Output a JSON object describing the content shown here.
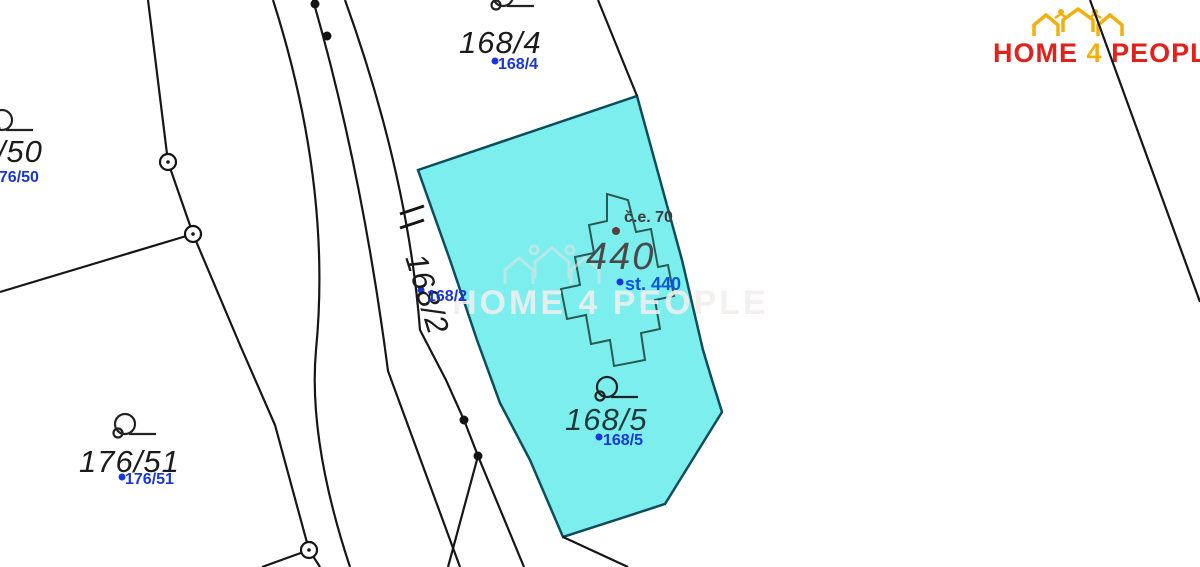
{
  "logo": {
    "home": "HOME",
    "four": "4",
    "people": "PEOPLE",
    "red": "#e3211b",
    "yellow": "#f2b010"
  },
  "watermark": {
    "text": "HOME 4 PEOPLE"
  },
  "map": {
    "highlight_color": "#7ceeee",
    "line_color": "#161616",
    "parcels": [
      {
        "id": "168/4",
        "label_black": "168/4",
        "label_blue": "168/4"
      },
      {
        "id": "176/50",
        "label_black": "176/50",
        "label_blue": "176/50"
      },
      {
        "id": "176/51",
        "label_black": "176/51",
        "label_blue": "176/51"
      },
      {
        "id": "168/2",
        "label_black": "168/2",
        "label_blue": "168/2"
      },
      {
        "id": "168/5",
        "label_black": "168/5",
        "label_blue": "168/5"
      }
    ],
    "building": {
      "number": "440",
      "label_blue": "st. 440",
      "note": "č.e. 70"
    }
  }
}
